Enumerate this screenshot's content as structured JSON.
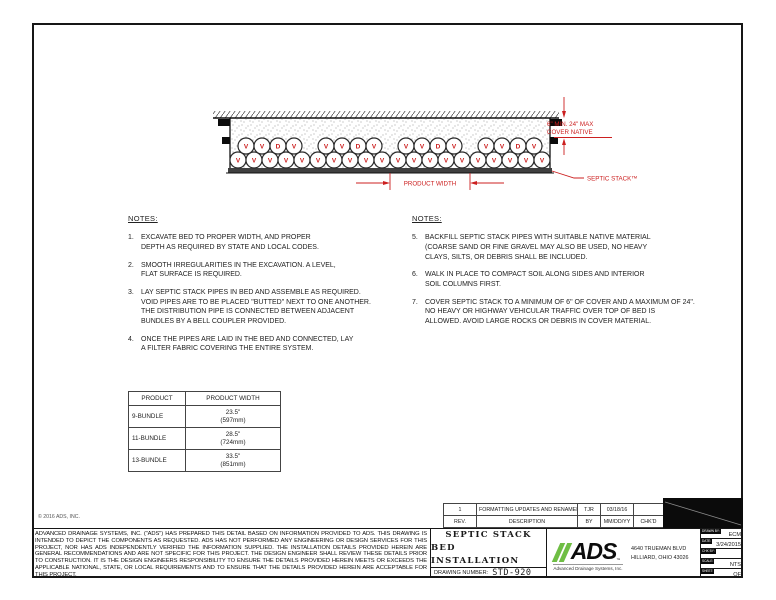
{
  "sheet": {
    "copyright": "© 2016 ADS, INC.",
    "disclaimer": "ADVANCED DRAINAGE SYSTEMS, INC. (\"ADS\") HAS PREPARED THIS DETAIL BASED ON INFORMATION PROVIDED TO ADS.  THIS DRAWING IS INTENDED TO DEPICT THE COMPONENTS AS REQUESTED.  ADS HAS NOT PERFORMED ANY ENGINEERING OR DESIGN SERVICES FOR THIS PROJECT, NOR HAS ADS INDEPENDENTLY VERIFIED THE INFORMATION SUPPLIED.  THE INSTALLATION DETAILS PROVIDED HEREIN ARE GENERAL RECOMMENDATIONS AND ARE NOT SPECIFIC FOR THIS PROJECT.  THE DESIGN ENGINEER SHALL REVIEW THESE DETAILS PRIOR TO CONSTRUCTION.  IT IS THE DESIGN ENGINEERS RESPONSIBILITY TO ENSURE THE DETAILS PROVIDED HEREIN MEETS OR EXCEEDS THE APPLICABLE NATIONAL, STATE, OR LOCAL REQUIREMENTS AND TO ENSURE THAT THE DETAILS PROVIDED HEREIN ARE ACCEPTABLE FOR THIS PROJECT."
  },
  "drawing": {
    "red": "#cc2020",
    "bundles": 4,
    "top_letters": [
      "V",
      "V",
      "D",
      "V"
    ],
    "bottom_letters": [
      "V",
      "V",
      "V",
      "V",
      "V"
    ],
    "labels": {
      "cover_line1": "6\" MIN. 24\" MAX",
      "cover_line2": "COVER NATIVE",
      "product_width": "PRODUCT WIDTH",
      "septic_stack": "SEPTIC STACK™"
    }
  },
  "notes_left": {
    "heading": "NOTES:",
    "start": 1,
    "items": [
      "EXCAVATE BED TO PROPER WIDTH, AND PROPER\nDEPTH AS REQUIRED BY STATE AND LOCAL CODES.",
      "SMOOTH IRREGULARITIES IN THE EXCAVATION.  A LEVEL,\nFLAT SURFACE IS REQUIRED.",
      "LAY SEPTIC STACK PIPES IN BED AND ASSEMBLE AS REQUIRED.\nVOID PIPES ARE TO BE PLACED \"BUTTED\" NEXT TO ONE ANOTHER.\nTHE DISTRIBUTION PIPE IS CONNECTED BETWEEN ADJACENT\nBUNDLES BY A BELL COUPLER PROVIDED.",
      "ONCE THE PIPES ARE LAID IN THE BED AND CONNECTED, LAY\nA FILTER FABRIC COVERING THE ENTIRE SYSTEM."
    ]
  },
  "notes_right": {
    "heading": "NOTES:",
    "start": 5,
    "items": [
      "BACKFILL SEPTIC STACK PIPES WITH SUITABLE NATIVE MATERIAL\n(COARSE SAND OR FINE GRAVEL MAY ALSO BE USED, NO HEAVY\nCLAYS, SILTS, OR DEBRIS SHALL BE INCLUDED.",
      "WALK IN PLACE TO COMPACT SOIL ALONG SIDES AND INTERIOR\nSOIL COLUMNS FIRST.",
      "COVER SEPTIC STACK TO A MINIMUM OF 6\" OF COVER AND A MAXIMUM OF 24\".\nNO HEAVY OR HIGHWAY VEHICULAR TRAFFIC OVER TOP OF BED IS\nALLOWED. AVOID LARGE ROCKS OR DEBRIS IN COVER MATERIAL."
    ]
  },
  "product_table": {
    "col1": "PRODUCT",
    "col2": "PRODUCT WIDTH",
    "rows": [
      [
        "9-BUNDLE",
        "23.5\"",
        "(597mm)"
      ],
      [
        "11-BUNDLE",
        "28.5\"",
        "(724mm)"
      ],
      [
        "13-BUNDLE",
        "33.5\"",
        "(851mm)"
      ]
    ]
  },
  "revisions": {
    "entry": [
      "1",
      "FORMATTING UPDATES AND RENAMED",
      "TJR",
      "03/18/16",
      ""
    ],
    "headers": [
      "REV.",
      "DESCRIPTION",
      "BY",
      "MM/DD/YY",
      "CHK'D"
    ]
  },
  "title_block": {
    "title1": "SEPTIC STACK",
    "title2": "BED INSTALLATION",
    "drawing_number_label": "DRAWING NUMBER:",
    "drawing_number": "STD-920",
    "logo": {
      "text": "ADS",
      "tm": "™",
      "sub": "Advanced Drainage Systems, Inc.",
      "green": "#6fbe44"
    },
    "address1": "4640 TRUEMAN BLVD",
    "address2": "HILLIARD, OHIO 43026",
    "info_rows": [
      {
        "label": "DRAWN BY:",
        "value": "ECM"
      },
      {
        "label": "DATE:",
        "value": "3/24/2015"
      },
      {
        "label": "CHK BY:",
        "value": ""
      },
      {
        "label": "SCALE:",
        "value": "NTS"
      },
      {
        "label": "SHEET:",
        "value": "OF"
      }
    ]
  }
}
